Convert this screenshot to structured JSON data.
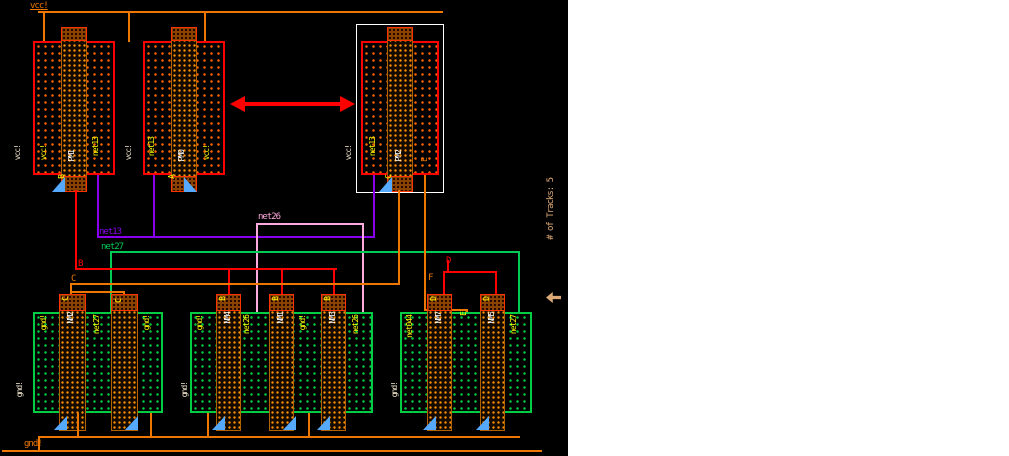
{
  "power": {
    "vcc": "vcc!",
    "gnd": "gnd!"
  },
  "status": {
    "tracks": "# of Tracks: 5"
  },
  "pmos": {
    "pm1": {
      "name": "PM1",
      "gate": "B",
      "sd_left": "vcc!",
      "sd_right": "net13",
      "well": "vcc!"
    },
    "pm0": {
      "name": "PM0",
      "gate": "A",
      "sd_left": "net13",
      "sd_right": "vcc!",
      "well": "vcc!"
    },
    "pm2": {
      "name": "PM2",
      "gate": "C",
      "sd_left": "net13",
      "sd_right": "E",
      "well": "vcc!",
      "selected": true
    }
  },
  "nmos": {
    "left": {
      "well": "gnd!",
      "sd1": "gnd!",
      "g1": "C",
      "g1_name": "NM2",
      "sd2": "net27",
      "g2": "C",
      "sd3": "gnd!"
    },
    "mid": {
      "well": "gnd!",
      "sd1": "gnd!",
      "g1": "B",
      "g1_name": "NM4",
      "sd2": "net26",
      "g2": "B",
      "g2_name": "NM1",
      "sd3": "gnd!",
      "g3": "B",
      "g3_name": "NM3",
      "sd4": "net26"
    },
    "right": {
      "well": "gnd!",
      "sd1": "net044",
      "g1": "D",
      "g1_name": "NM7",
      "sd2": "E",
      "g2": "D",
      "g2_name": "NM5",
      "sd3": "net27"
    }
  },
  "nets": {
    "net13": "net13",
    "net26": "net26",
    "net27": "net27",
    "b": "B",
    "c": "C",
    "d": "D",
    "f": "F"
  },
  "colors": {
    "metal": "#ee7700",
    "outline_red": "#ff0000",
    "net13": "#8800ee",
    "net26": "#ffaadd",
    "net27": "#00cc55",
    "nmos": "#00cc44",
    "label_yellow": "#ffff00",
    "select": "#ffffff",
    "marker": "#55aaff",
    "tracks": "#ddaa77"
  }
}
